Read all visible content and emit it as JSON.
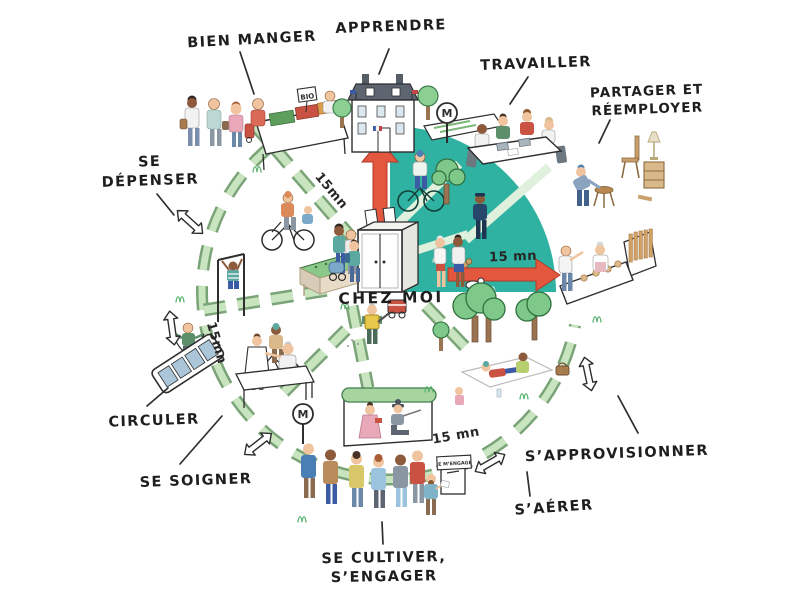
{
  "center": {
    "label": "CHEZ MOI"
  },
  "activities": {
    "bien_manger": "BIEN MANGER",
    "apprendre": "APPRENDRE",
    "travailler": "TRAVAILLER",
    "partager_line1": "PARTAGER ET",
    "partager_line2": "RÉEMPLOYER",
    "se_depenser_line1": "SE",
    "se_depenser_line2": "DÉPENSER",
    "circuler": "CIRCULER",
    "se_soigner": "SE SOIGNER",
    "se_cultiver_line1": "SE CULTIVER,",
    "se_cultiver_line2": "S’ENGAGER",
    "s_aerer": "S’AÉRER",
    "s_approvisionner": "S’APPROVISIONNER"
  },
  "travel_times": {
    "northwest": "15mn",
    "west": "15mn",
    "east": "15 mn",
    "south": "15 mn"
  },
  "signs": {
    "bio": "BIO",
    "metro": "M",
    "ballot": "JE M’ENGAGE"
  },
  "colors": {
    "district_teal": "#2fb2a1",
    "path_green": "#b9dcae",
    "arrow_red": "#e4573f",
    "ink": "#2e2e2e"
  }
}
